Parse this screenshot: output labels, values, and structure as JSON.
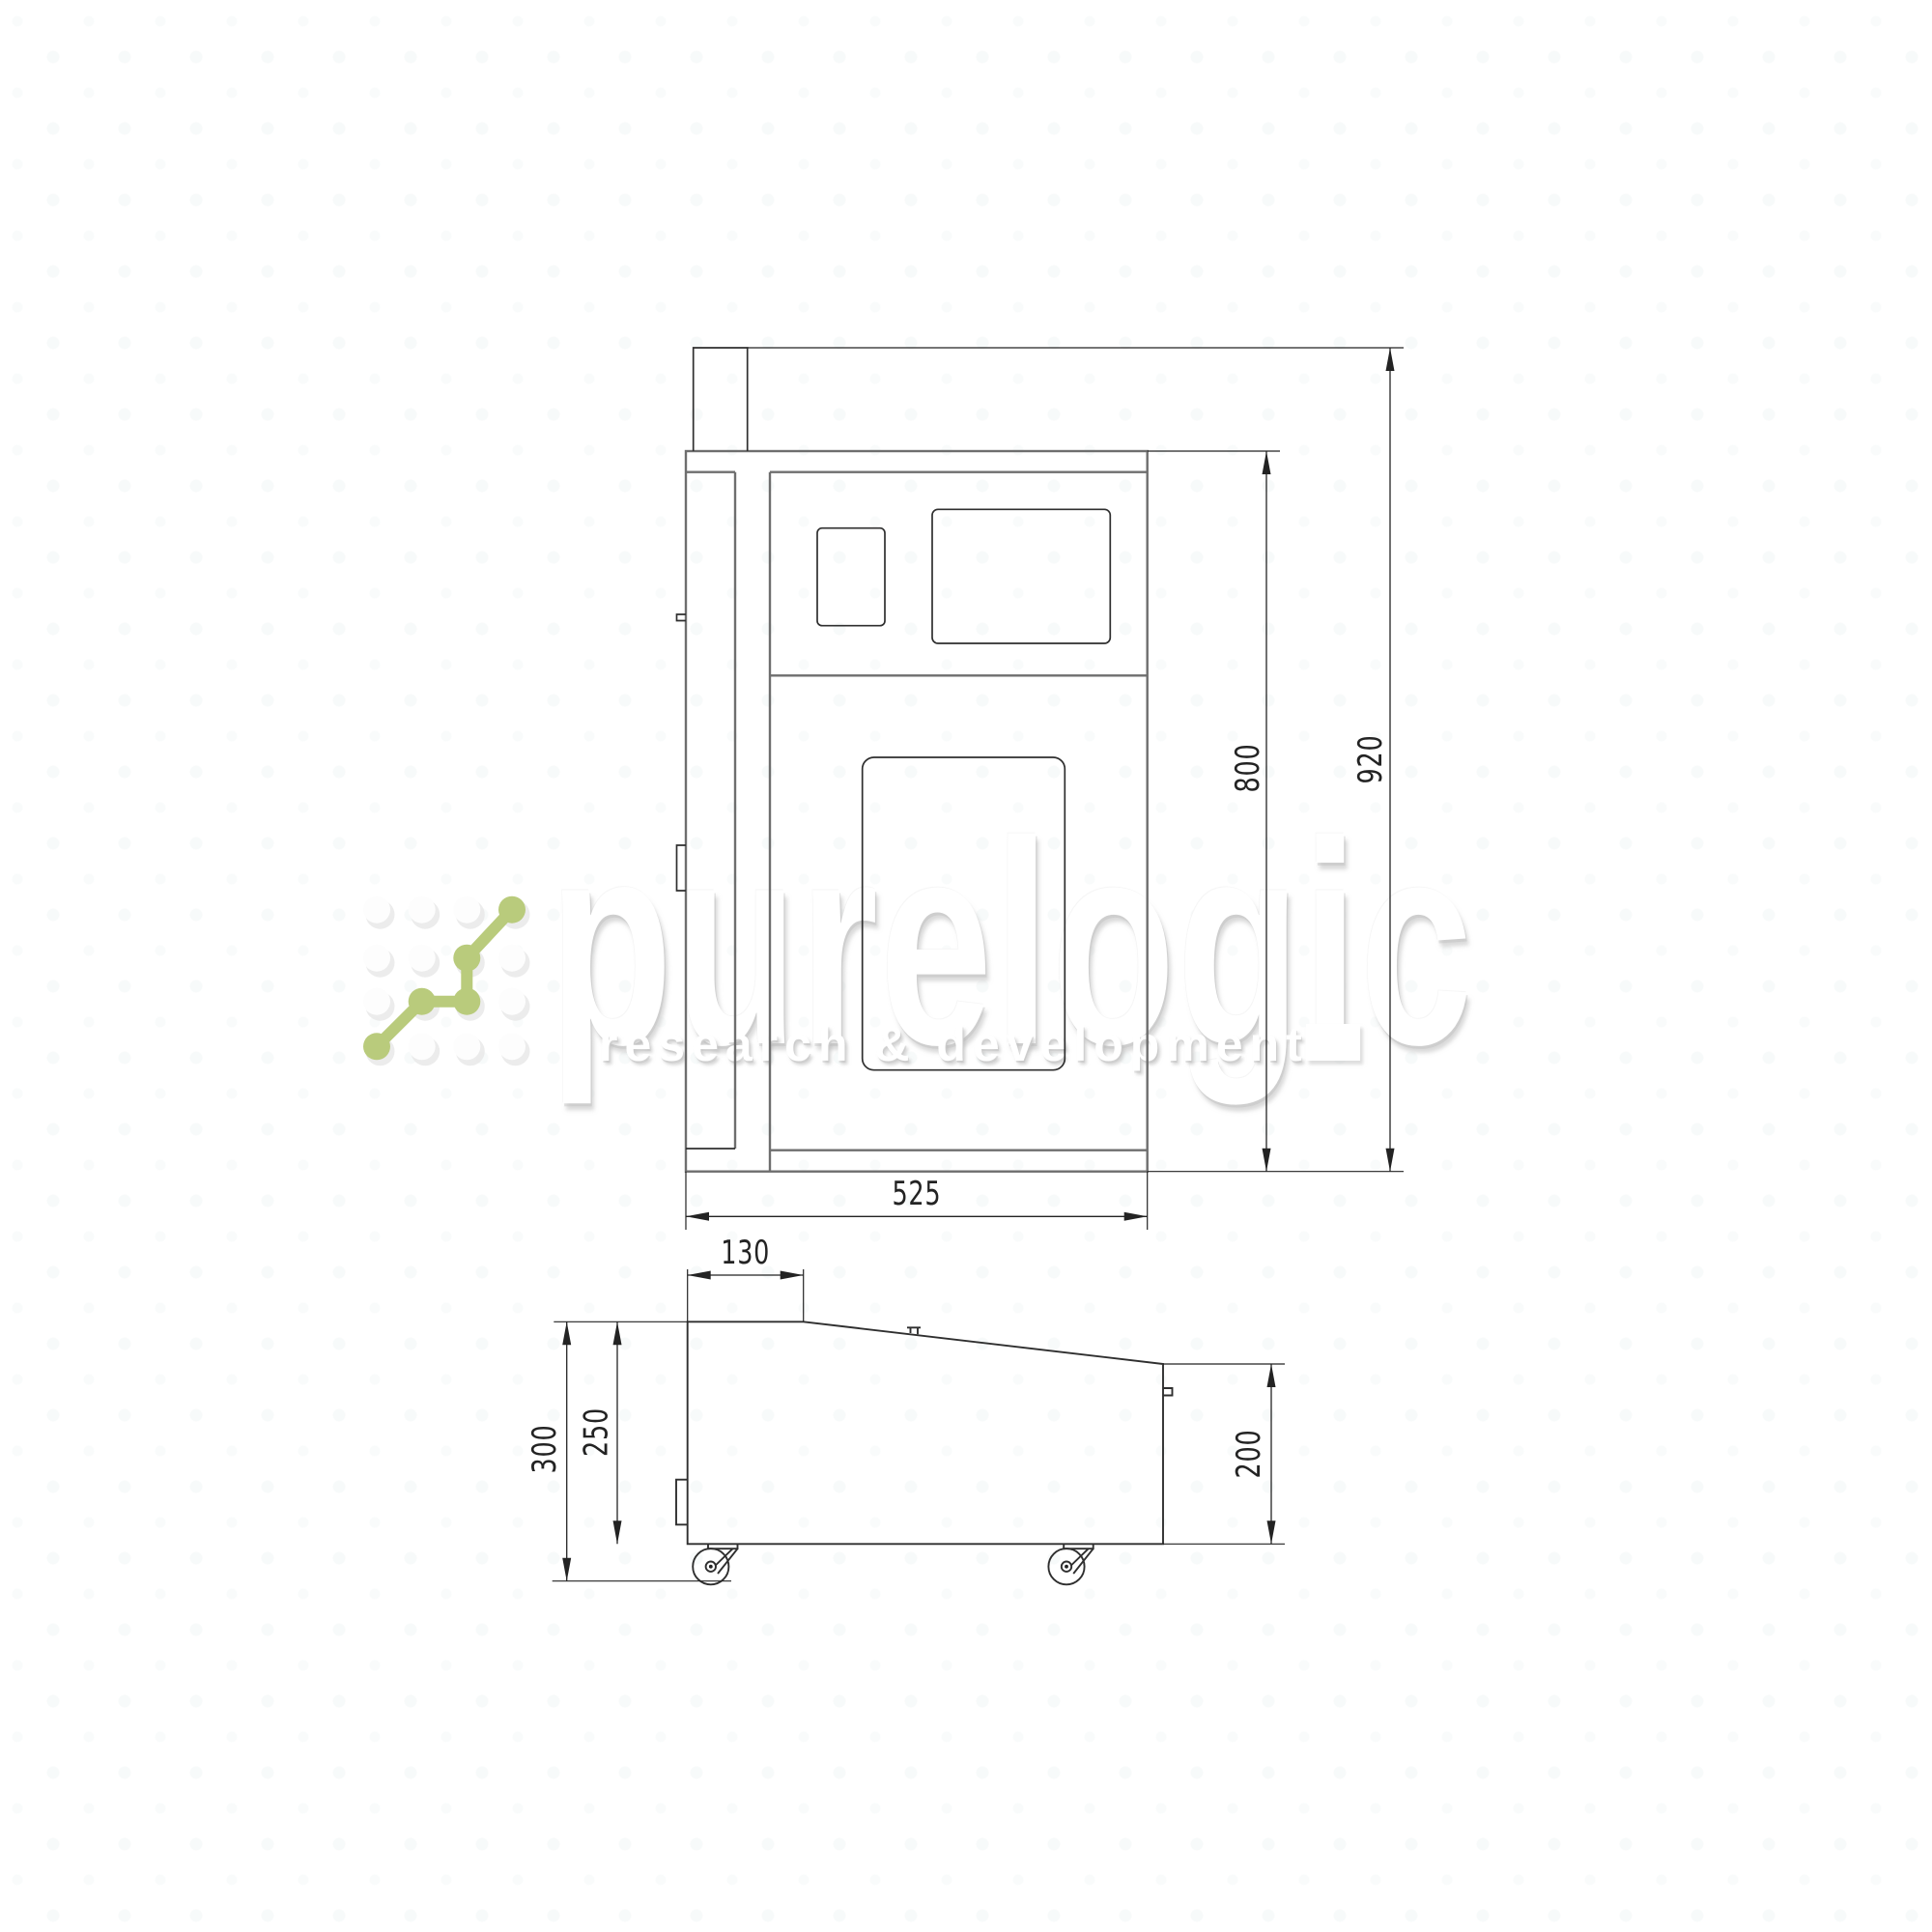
{
  "colors": {
    "line_primary": "#6e6e6e",
    "line_detail": "#2f2f2f",
    "dim": "#232323",
    "logo_green": "#b9cb7c",
    "watermark_white": "#ffffff"
  },
  "watermark": {
    "brand": "purelogic",
    "tagline": "research & development"
  },
  "front_view": {
    "dim_total_height": "920",
    "dim_body_height": "800",
    "dim_width": "525"
  },
  "side_view": {
    "dim_top_flat": "130",
    "dim_total_height": "300",
    "dim_body_height": "250",
    "dim_rear_height": "200"
  }
}
